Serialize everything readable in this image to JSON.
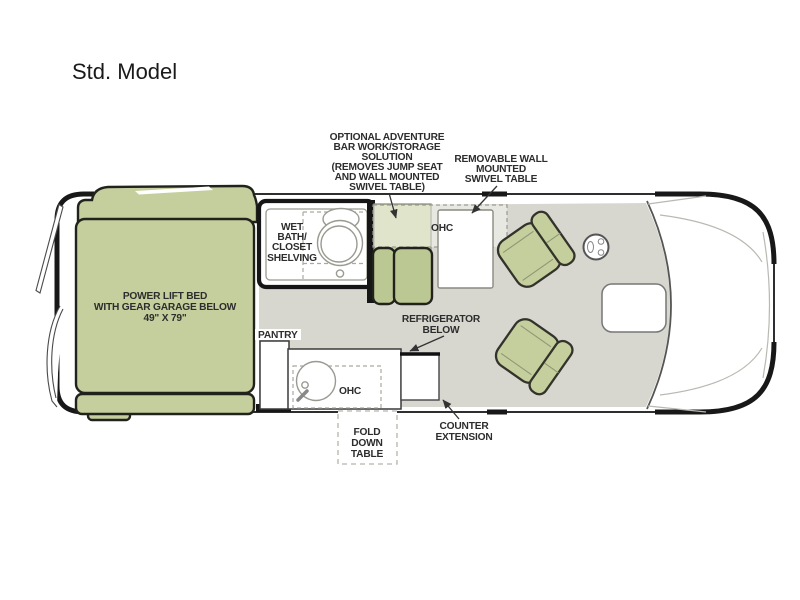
{
  "title": "Std. Model",
  "colors": {
    "furniture_green": "#c5cf9e",
    "cushion_green": "#bcc893",
    "floor_gray": "#d7d7cf",
    "outline_black": "#181818",
    "label_text": "#2d2d2d"
  },
  "floorplan": {
    "labels": {
      "adventure_bar": {
        "lines": [
          "OPTIONAL ADVENTURE",
          "BAR WORK/STORAGE",
          "SOLUTION",
          "(REMOVES JUMP SEAT",
          "AND WALL MOUNTED",
          "SWIVEL TABLE)"
        ]
      },
      "swivel_table": {
        "lines": [
          "REMOVABLE WALL",
          "MOUNTED",
          "SWIVEL TABLE"
        ]
      },
      "wet_bath": {
        "lines": [
          "WET",
          "BATH/",
          "CLOSET",
          "SHELVING"
        ]
      },
      "bed": {
        "lines": [
          "POWER LIFT BED",
          "WITH GEAR GARAGE BELOW",
          "49\" X 79\""
        ]
      },
      "pantry": "PANTRY",
      "refrigerator": {
        "lines": [
          "REFRIGERATOR",
          "BELOW"
        ]
      },
      "ohc_upper": "OHC",
      "ohc_galley": "OHC",
      "fold_table": {
        "lines": [
          "FOLD",
          "DOWN",
          "TABLE"
        ]
      },
      "counter_extension": {
        "lines": [
          "COUNTER",
          "EXTENSION"
        ]
      }
    }
  }
}
